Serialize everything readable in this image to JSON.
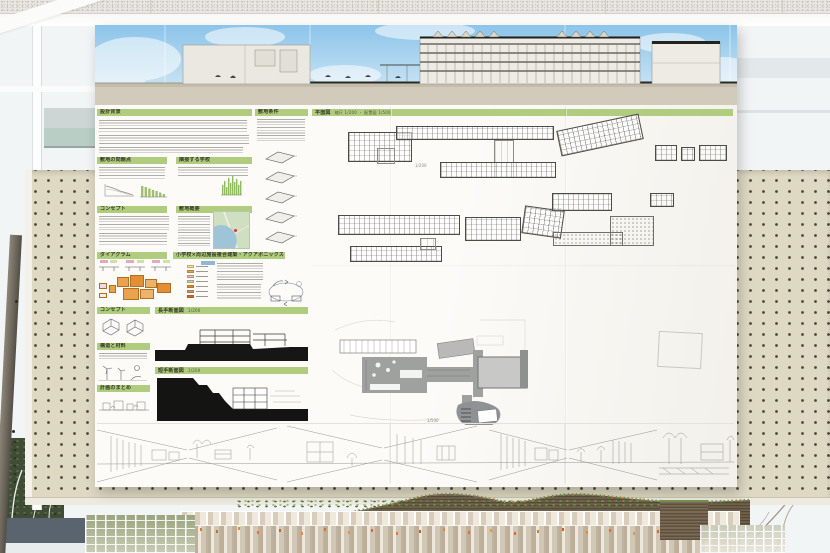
{
  "colors": {
    "header_green": "#b0cc7e",
    "sky_top": "#8cc4e9",
    "sky_bottom": "#c2e0f2",
    "pegboard": "#ded9c3",
    "accent_orange": "#e2762f",
    "roof_brown": "#70614a"
  },
  "poster": {
    "sections": {
      "background": "設計背景",
      "site_conditions": "敷地条件",
      "site_issues": "敷地の問題点",
      "adjacent_school": "隣接する学校",
      "concept": "コンセプト",
      "site_overview": "敷地概要",
      "diagram": "ダイアグラム",
      "program": "小学校×周辺施設複合建築・アクアポニックス",
      "concept_model": "コンセプト",
      "structure": "構造と材料",
      "summary": "計画のまとめ",
      "long_section": "長手断面図",
      "cross_section": "短手断面図",
      "floor_plans": "平面図",
      "plan_subtitle": "縮尺 1/200 ・ 配置図 1/500",
      "section_scale": "1/200",
      "site_plan_scale": "1/500"
    },
    "diagram_legend": {
      "colors": [
        "#f2e39a",
        "#e8a24e",
        "#e3b7c9",
        "#d9c9a4",
        "#e0872f",
        "#c09a62",
        "#d65f2e"
      ]
    }
  }
}
